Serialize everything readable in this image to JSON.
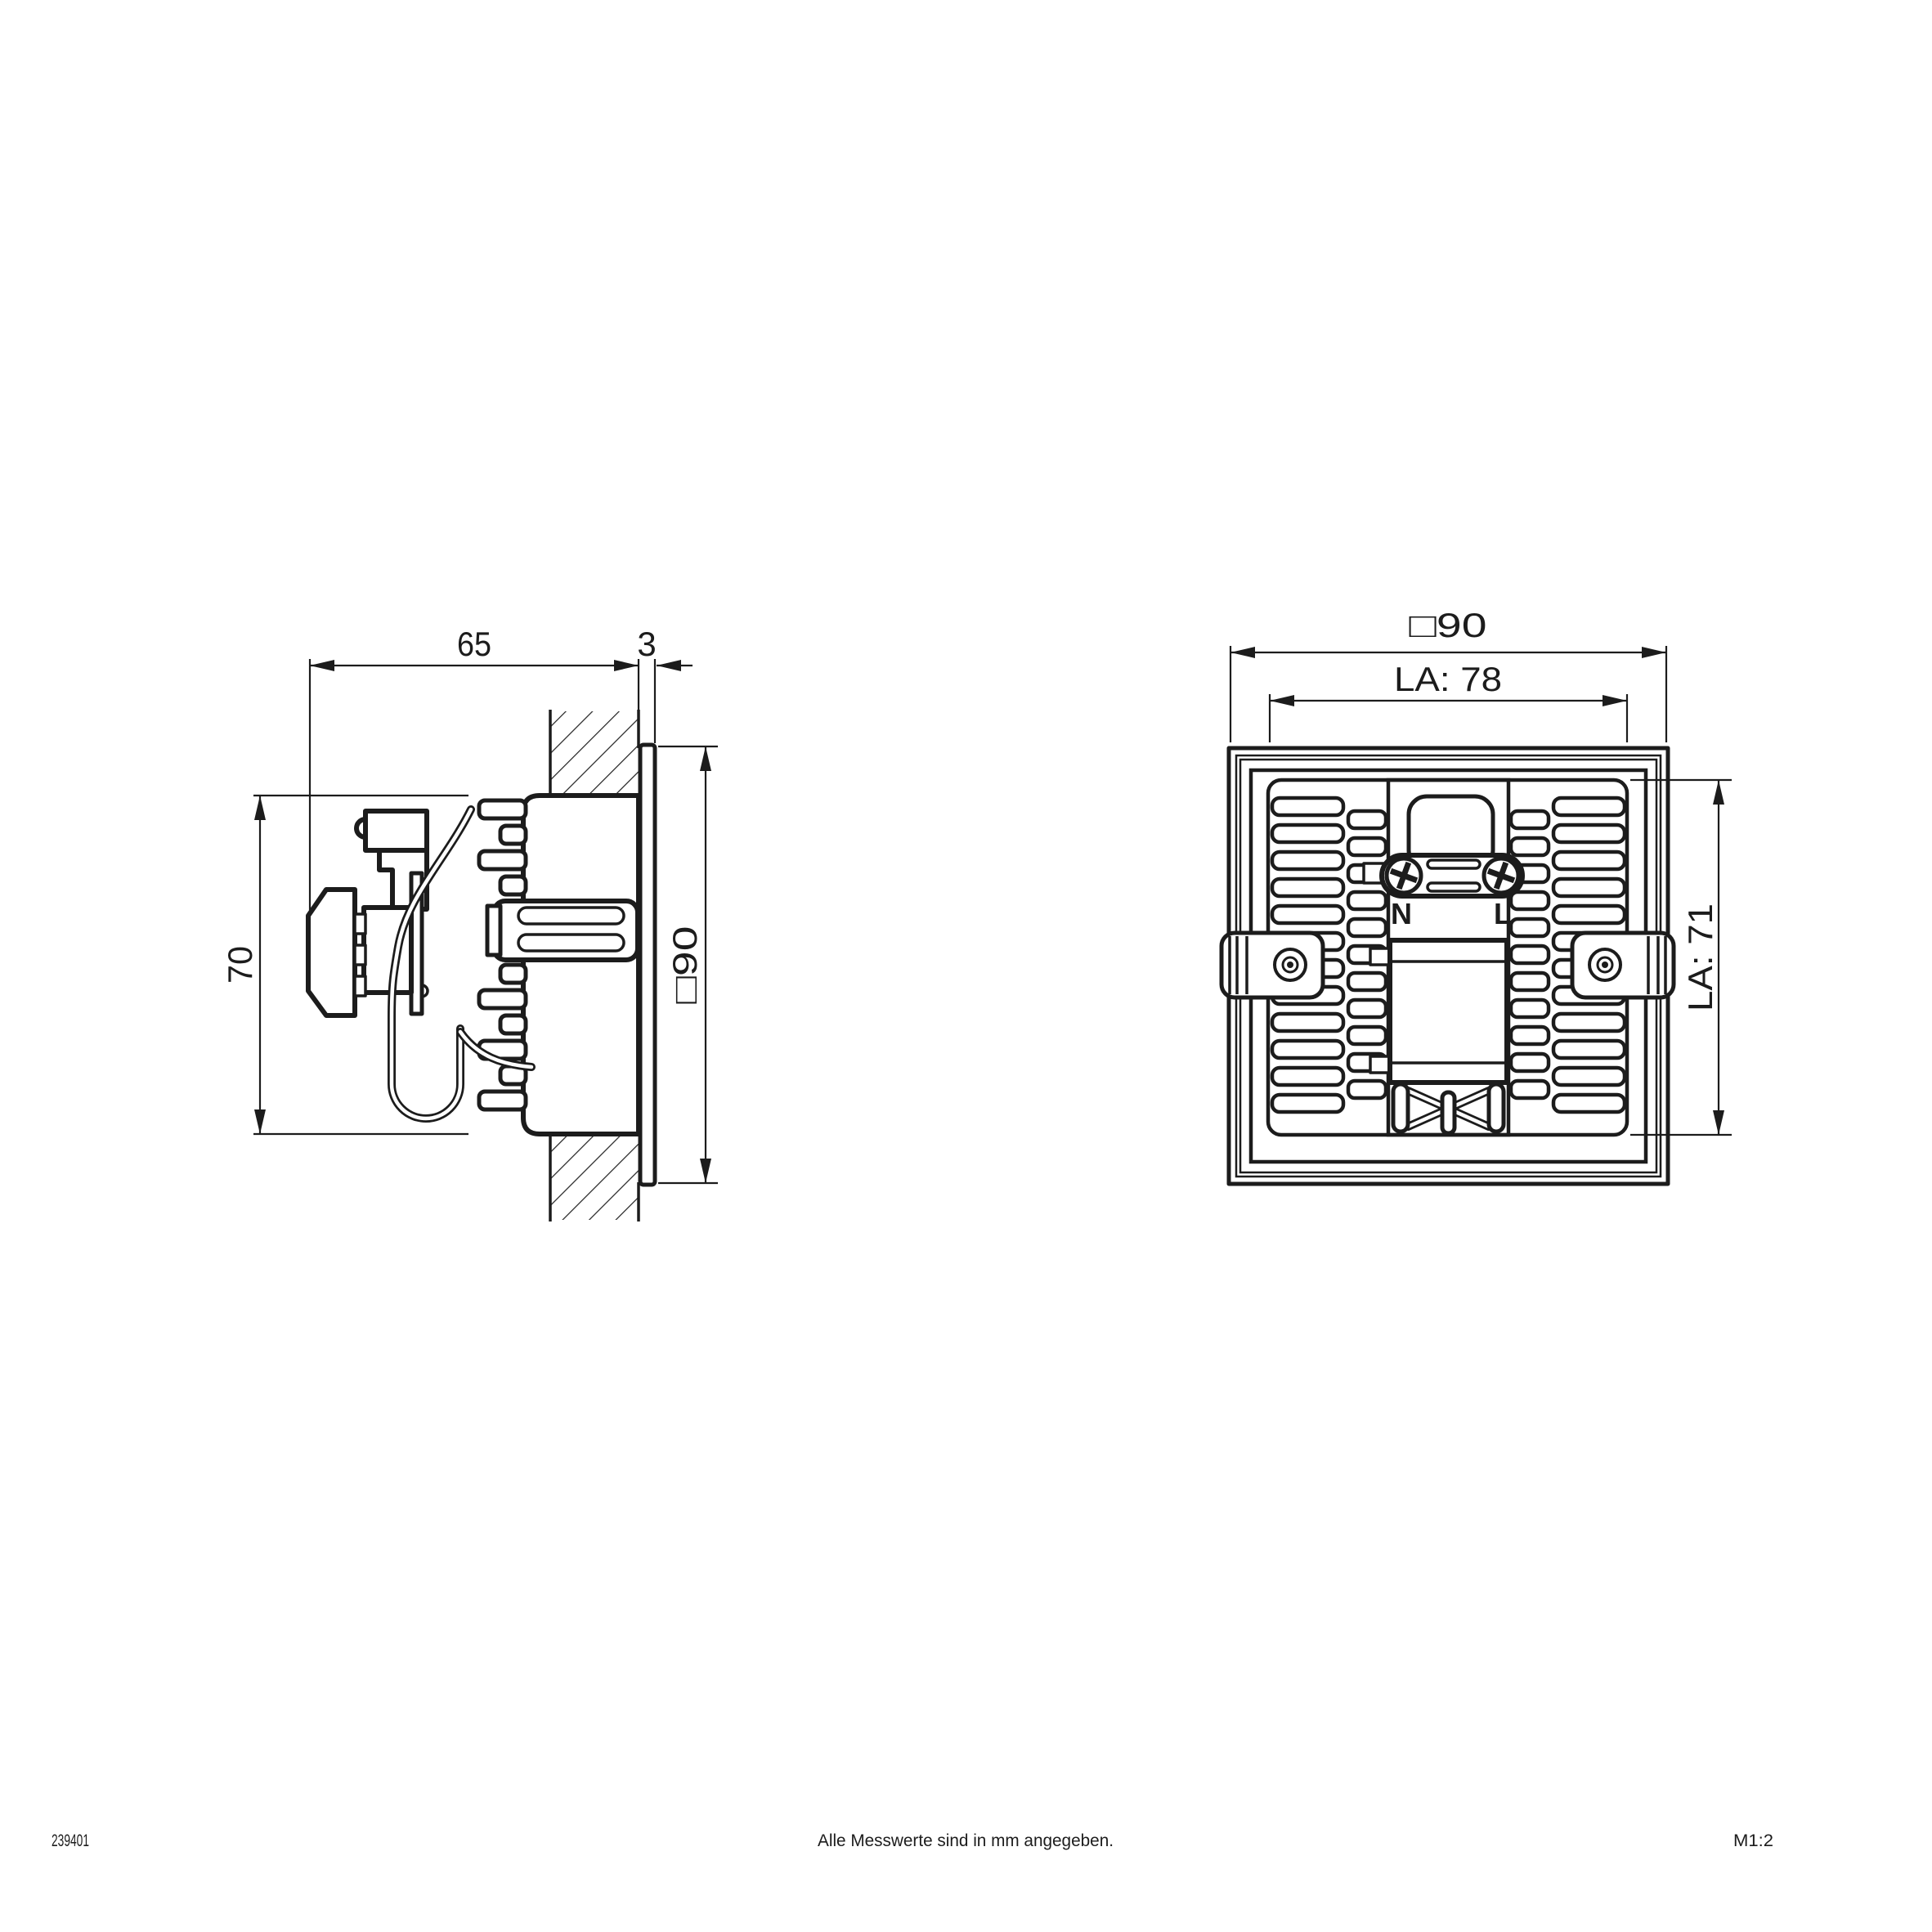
{
  "drawing": {
    "background": "#ffffff",
    "line_color": "#1c1c1c",
    "side_view": {
      "label_depth": "65",
      "label_bezel_thickness": "3",
      "label_face_size": "□90",
      "label_recess_depth": "70"
    },
    "rear_view": {
      "label_face_size": "□90",
      "label_cutout_width": "LA: 78",
      "label_cutout_height": "LA: 71",
      "terminal_neutral": "N",
      "terminal_live": "L"
    },
    "footer": {
      "article_number": "239401",
      "note": "Alle Messwerte sind in mm angegeben.",
      "scale": "M1:2"
    }
  }
}
